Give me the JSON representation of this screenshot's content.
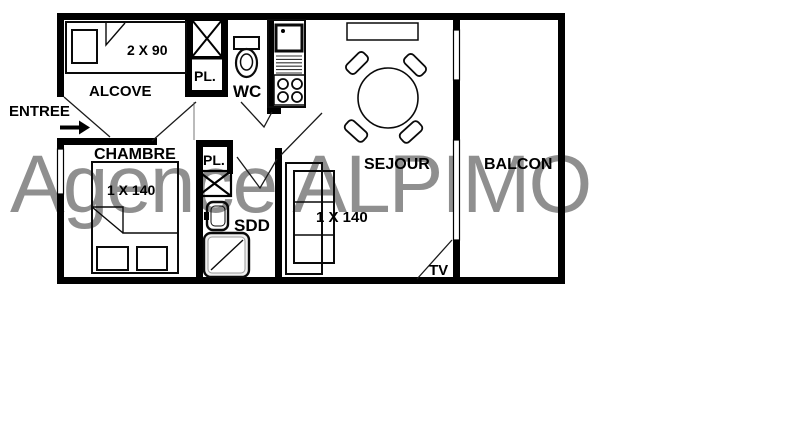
{
  "watermark": "Agence ALPIMO",
  "rooms": {
    "entree": "ENTREE",
    "alcove": "ALCOVE",
    "chambre": "CHAMBRE",
    "closet_top": "PL.",
    "wc": "WC",
    "closet_bottom": "PL.",
    "shower_room": "SDD",
    "sejour": "SEJOUR",
    "balcon": "BALCON",
    "tv": "TV"
  },
  "dimensions": {
    "alcove_bed": "2 X 90",
    "chambre_bed": "1 X 140",
    "sejour_sofa": "1 X 140"
  },
  "colors": {
    "line": "#000000",
    "watermark": "#8f8f8f",
    "background": "#ffffff",
    "shower_fill": "#efefef"
  }
}
